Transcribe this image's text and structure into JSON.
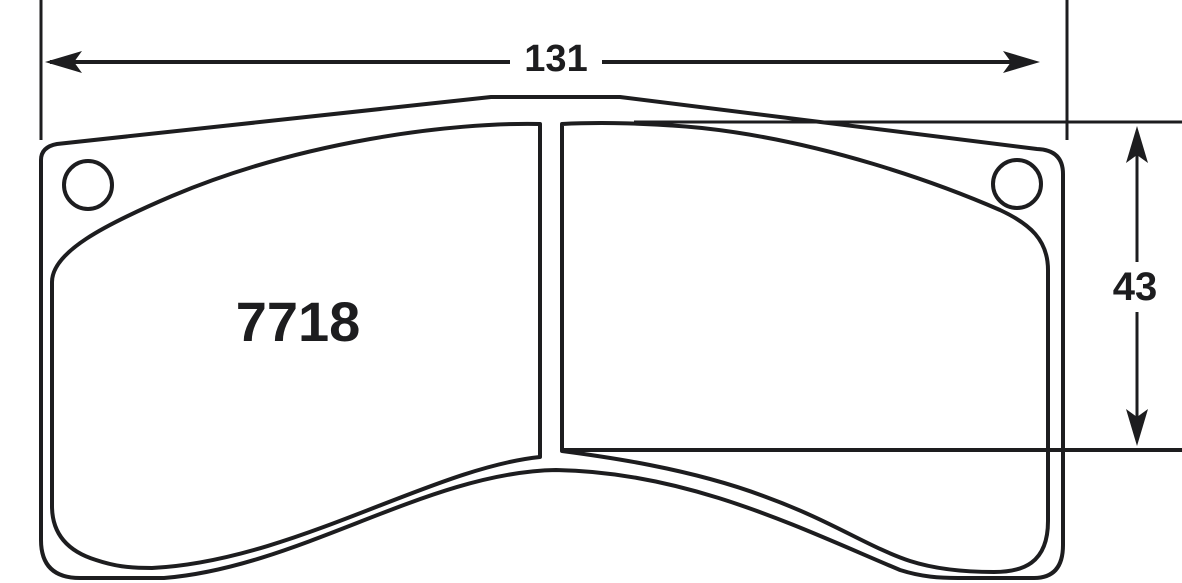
{
  "diagram": {
    "part_number": "7718",
    "dimensions": {
      "width_label": "131",
      "height_label": "43"
    },
    "colors": {
      "outline": "#1d1d1f",
      "friction_fill": "#e6e6e8",
      "backplate_fill": "#ffffff",
      "background": "#ffffff"
    }
  }
}
